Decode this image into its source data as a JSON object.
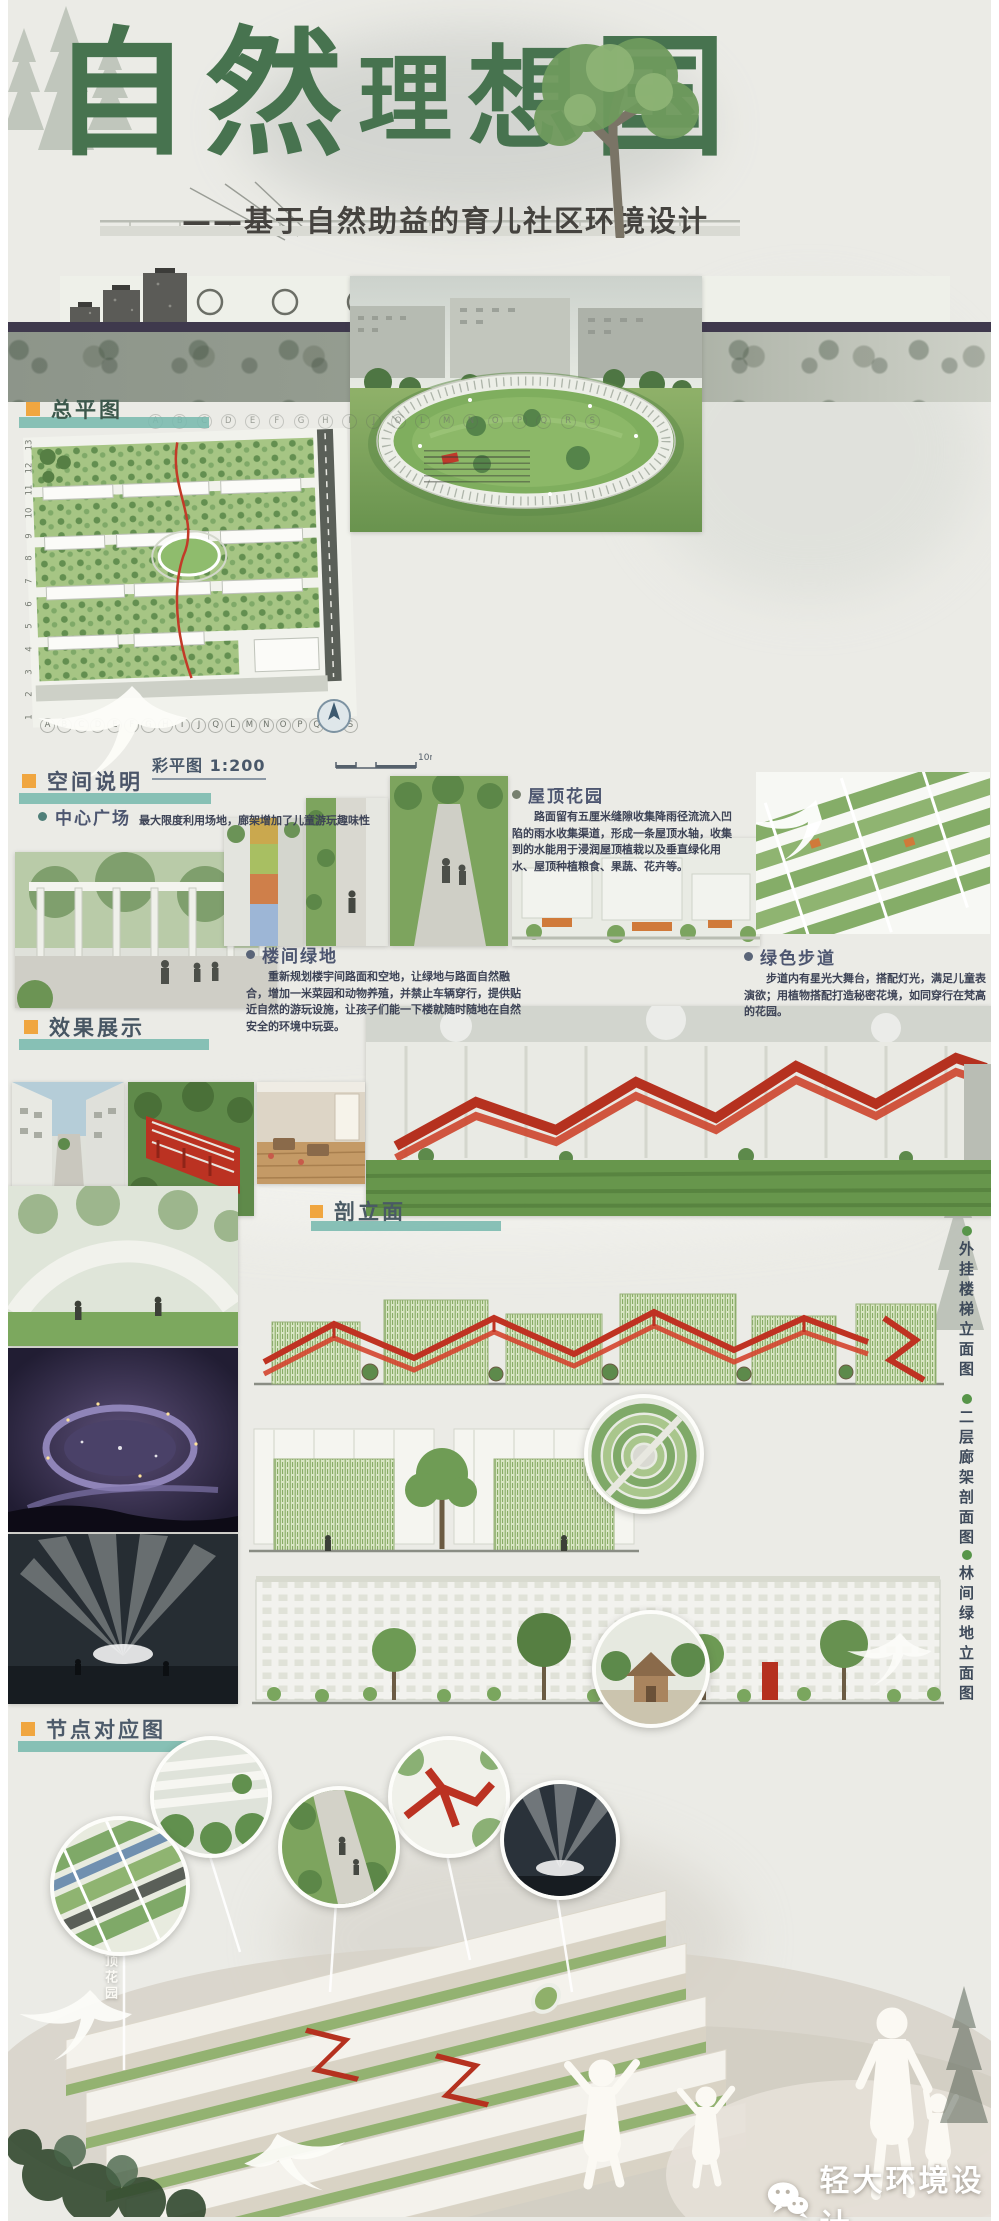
{
  "header": {
    "title": "自然理想国",
    "subtitle": "——基于自然助益的育儿社区环境设计"
  },
  "colors": {
    "title_green": "#47734f",
    "accent_orange": "#f0a640",
    "accent_teal": "#79b9ae",
    "structure_red": "#b5311f"
  },
  "sections": {
    "master_plan": {
      "heading": "总平图",
      "scale_label": "彩平图 1:200",
      "scale_mark": "10m",
      "grid_letters": [
        "A",
        "B",
        "C",
        "D",
        "E",
        "F",
        "G",
        "H",
        "I",
        "J",
        "Q",
        "L",
        "M",
        "N",
        "O",
        "P",
        "Q",
        "R",
        "S"
      ],
      "grid_numbers": [
        "13",
        "12",
        "11",
        "10",
        "9",
        "8",
        "7",
        "6",
        "5",
        "4",
        "3",
        "2",
        "1"
      ]
    },
    "space_notes": {
      "heading": "空间说明",
      "items": [
        {
          "title": "中心广场",
          "desc": "最大限度利用场地，廊架增加了儿童游玩趣味性"
        },
        {
          "title": "楼间绿地",
          "desc": "重新规划楼宇间路面和空地，让绿地与路面自然融合，增加一米菜园和动物养殖，并禁止车辆穿行，提供贴近自然的游玩设施，让孩子们能一下楼就随时随地在自然安全的环境中玩耍。"
        },
        {
          "title": "屋顶花园",
          "desc": "路面留有五厘米缝隙收集降雨径流流入凹陷的雨水收集渠道，形成一条屋顶水轴，收集到的水能用于浸润屋顶植栽以及垂直绿化用水、屋顶种植粮食、果蔬、花卉等。"
        },
        {
          "title": "绿色步道",
          "desc": "步道内有星光大舞台，搭配灯光，满足儿童表演欲；用植物搭配打造秘密花境，如同穿行在梵高的花园。"
        }
      ]
    },
    "effects": {
      "heading": "效果展示"
    },
    "sections_drawings": {
      "heading": "剖立面",
      "labels": [
        "外挂楼梯立面图",
        "二层廊架剖面图",
        "林间绿地立面图"
      ]
    },
    "nodes": {
      "heading": "节点对应图",
      "node_label": "屋顶花园"
    }
  },
  "watermark": {
    "name": "轻大环境设计",
    "icon": "wechat-icon"
  }
}
